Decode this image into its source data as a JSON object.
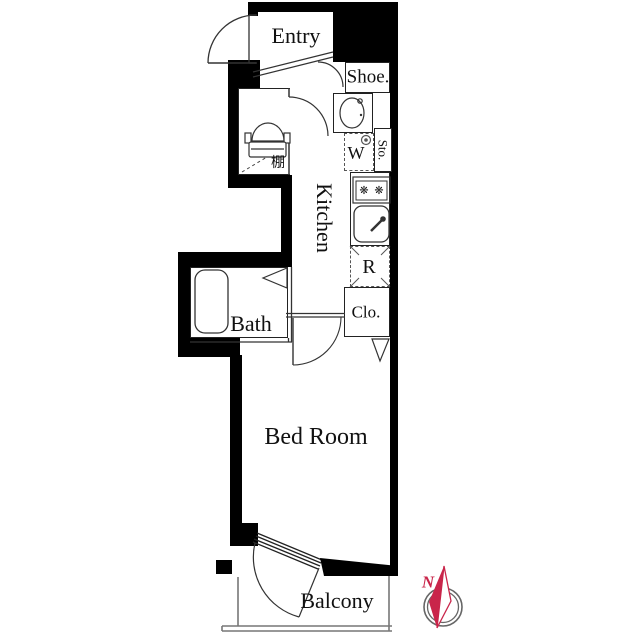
{
  "labels": {
    "entry": "Entry",
    "shoe": "Shoe.",
    "washer": "W",
    "storage": "Sto.",
    "kitchen": "Kitchen",
    "fridge": "R",
    "closet": "Clo.",
    "bath": "Bath",
    "shelf": "棚",
    "bedroom": "Bed Room",
    "balcony": "Balcony",
    "north": "N"
  },
  "icons": {
    "burner": "❋",
    "toilet": "toilet-icon",
    "bathtub": "bathtub-icon",
    "vanity_sink": "sink-icon",
    "kitchen_sink": "kitchen-sink-icon",
    "stove": "stove-icon",
    "washer_tap": "washer-tap-icon",
    "compass": "compass-icon"
  },
  "colors": {
    "wall": "#000000",
    "line": "#333333",
    "compass_red": "#c9254a",
    "background": "#ffffff"
  }
}
